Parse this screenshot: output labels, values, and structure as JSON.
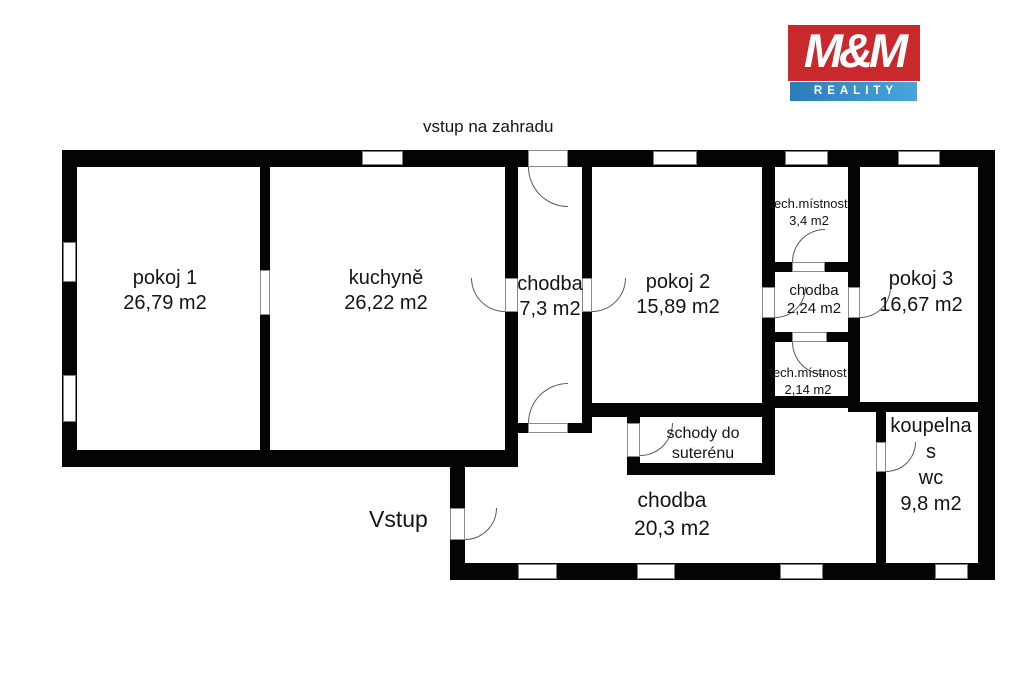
{
  "logo": {
    "brand": "M&M",
    "tagline": "REALITY",
    "brand_bg": "#c9282d",
    "tagline_bg_from": "#2b7cb9",
    "tagline_bg_to": "#4aa5dc"
  },
  "plan": {
    "labels": {
      "garden_entrance": "vstup na zahradu",
      "entrance": "Vstup"
    },
    "rooms": [
      {
        "id": "pokoj-1",
        "lines": [
          "pokoj 1",
          "26,79 m2"
        ]
      },
      {
        "id": "kuchyne",
        "lines": [
          "kuchyně",
          "26,22 m2"
        ]
      },
      {
        "id": "chodba-horni",
        "lines": [
          "chodba",
          "7,3 m2"
        ]
      },
      {
        "id": "pokoj-2",
        "lines": [
          "pokoj 2",
          "15,89 m2"
        ]
      },
      {
        "id": "tech-mistnost-horni",
        "lines": [
          "tech.místnost",
          "3,4 m2"
        ]
      },
      {
        "id": "chodba-stredni",
        "lines": [
          "chodba",
          "2,24 m2"
        ]
      },
      {
        "id": "tech-mistnost-dolni",
        "lines": [
          "tech.místnost",
          "2,14 m2"
        ]
      },
      {
        "id": "pokoj-3",
        "lines": [
          "pokoj 3",
          "16,67 m2"
        ]
      },
      {
        "id": "schody-do-suterenu",
        "lines": [
          "schody do",
          "suterénu"
        ]
      },
      {
        "id": "chodba-vstupni",
        "lines": [
          "chodba",
          "20,3 m2"
        ]
      },
      {
        "id": "koupelna-s-wc",
        "lines": [
          "koupelna",
          "s",
          "wc",
          "9,8 m2"
        ]
      }
    ]
  }
}
